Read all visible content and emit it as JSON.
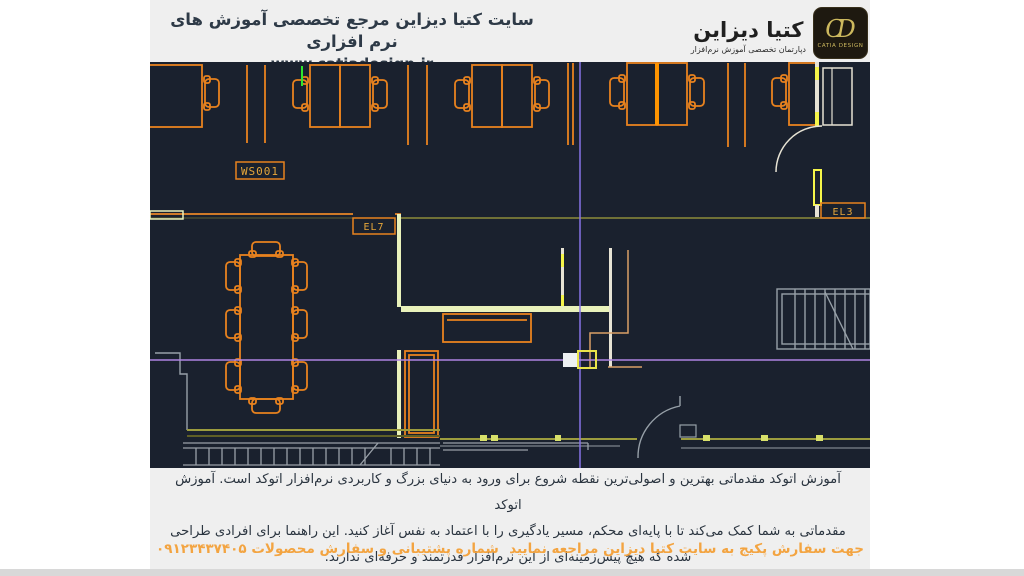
{
  "page": {
    "background": "#ffffff",
    "panel_background": "#efefef",
    "accent_orange": "#f3a441",
    "text_dark": "#2b3540",
    "bottom_bar_color": "#d8d8d8"
  },
  "header": {
    "title": "سایت کتیا دیزاین مرجع تخصصی آموزش های نرم افزاری",
    "website": "www.catiadesign.ir",
    "logo": {
      "wordmark": "کتیا دیزاین",
      "subtitle": "دپارتمان تخصصی آموزش نرم‌افزار",
      "badge_monogram": "CD",
      "badge_caption": "CATIA DESIGN",
      "badge_background": "#1e1910",
      "badge_gold": "#cdb95e"
    }
  },
  "cad": {
    "background": "#1a212e",
    "labels": {
      "workstation": "WS001",
      "el7": "EL7",
      "el3": "EL3"
    },
    "colors": {
      "furniture_orange": "#e8821e",
      "bright_partition_orange": "#ff9400",
      "wall_cream": "#e7e3d4",
      "wall_lime": "#e9f2bb",
      "wall_olive": "#9c9c3e",
      "door_jamb_yellow": "#f5f549",
      "stairs_gray": "#97a0a8",
      "tan_wall": "#d9a066",
      "crosshair_purple": "#8673e6",
      "osnap_yellow": "#e8e44a",
      "green_marker": "#2ee82e"
    }
  },
  "body_text": {
    "line1": "آموزش اتوکد مقدماتی بهترین و اصولی‌ترین نقطه شروع برای ورود به دنیای بزرگ و کاربردی نرم‌افزار اتوکد است. آموزش اتوکد",
    "line2": "مقدماتی به شما کمک می‌کند تا با پایه‌ای محکم، مسیر یادگیری را با اعتماد به نفس آغاز کنید. این راهنما برای افرادی طراحی",
    "line3": "شده که هیچ پیش‌زمینه‌ای از این نرم‌افزار قدرتمند و حرفه‌ای ندارند."
  },
  "footer": {
    "order_note": "جهت سفارش پکیج به سایت کتیا دیزاین مراجعه نمایید",
    "support_note": "شماره پشتیبانی و سفارش محصولات ۰۹۱۲۳۴۳۷۴۰۵"
  }
}
